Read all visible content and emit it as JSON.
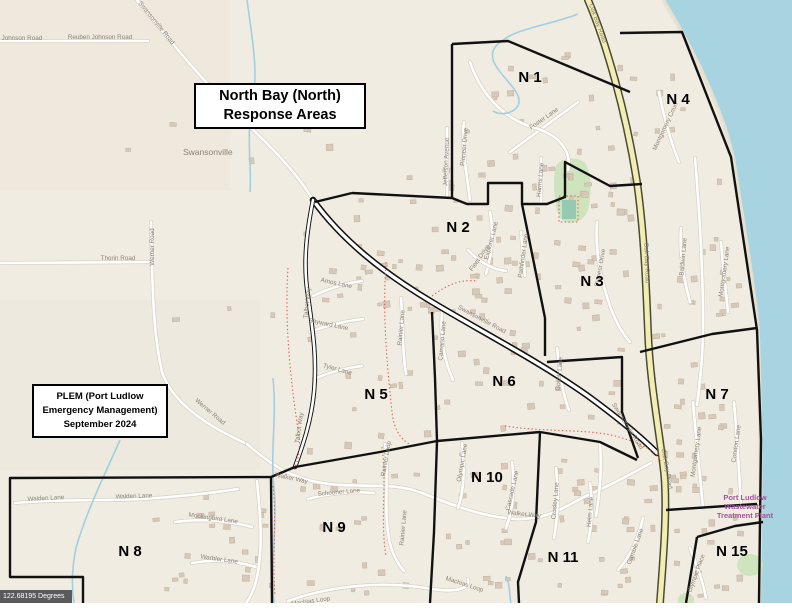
{
  "map": {
    "title_box": {
      "line1": "North Bay (North)",
      "line2": "Response Areas"
    },
    "credit_box": {
      "line1": "PLEM (Port Ludlow",
      "line2": "Emergency Management)",
      "line3": "September 2024"
    },
    "badge": {
      "text": "122.68195 Degrees"
    },
    "place": {
      "text": "Swansonville"
    },
    "poi": {
      "line1": "Port Ludlow",
      "line2": "Wastewater",
      "line3": "Treatment Plant",
      "color": "#a0549b"
    },
    "areas": [
      {
        "id": "N 1",
        "x": 530,
        "y": 82
      },
      {
        "id": "N 2",
        "x": 458,
        "y": 232
      },
      {
        "id": "N 3",
        "x": 592,
        "y": 286
      },
      {
        "id": "N 4",
        "x": 678,
        "y": 104
      },
      {
        "id": "N 5",
        "x": 376,
        "y": 399
      },
      {
        "id": "N 6",
        "x": 504,
        "y": 386
      },
      {
        "id": "N 7",
        "x": 717,
        "y": 399
      },
      {
        "id": "N 8",
        "x": 130,
        "y": 556
      },
      {
        "id": "N 9",
        "x": 334,
        "y": 532
      },
      {
        "id": "N 10",
        "x": 487,
        "y": 482
      },
      {
        "id": "N 11",
        "x": 563,
        "y": 562
      },
      {
        "id": "N 15",
        "x": 732,
        "y": 556
      }
    ],
    "street_labels": [
      {
        "t": "Reuben Johnson Road",
        "x": 100,
        "y": 39,
        "r": 0
      },
      {
        "t": "Reuben Johnson Road",
        "x": 10,
        "y": 40,
        "r": 0
      },
      {
        "t": "Swansonville Road",
        "x": 155,
        "y": 24,
        "r": 51
      },
      {
        "t": "Thorin Road",
        "x": 118,
        "y": 260,
        "r": 0
      },
      {
        "t": "Werner Road",
        "x": 154,
        "y": 247,
        "r": -90
      },
      {
        "t": "Werner Road",
        "x": 209,
        "y": 413,
        "r": 40
      },
      {
        "t": "Walden Lane",
        "x": 46,
        "y": 500,
        "r": -3
      },
      {
        "t": "Walden Lane",
        "x": 134,
        "y": 498,
        "r": -2
      },
      {
        "t": "Mockingbird Lane",
        "x": 213,
        "y": 520,
        "r": 8
      },
      {
        "t": "Warbler Lane",
        "x": 219,
        "y": 561,
        "r": 8
      },
      {
        "t": "Walker Way",
        "x": 291,
        "y": 480,
        "r": 12
      },
      {
        "t": "Walker Way",
        "x": 524,
        "y": 516,
        "r": 6
      },
      {
        "t": "Schooner Lane",
        "x": 339,
        "y": 494,
        "r": -5
      },
      {
        "t": "Machias Loop",
        "x": 311,
        "y": 603,
        "r": -8
      },
      {
        "t": "Machias Loop",
        "x": 464,
        "y": 586,
        "r": 18
      },
      {
        "t": "Rainier Loop",
        "x": 388,
        "y": 459,
        "r": -80
      },
      {
        "t": "Rainier Lane",
        "x": 405,
        "y": 528,
        "r": -85
      },
      {
        "t": "Rainier Lane",
        "x": 403,
        "y": 328,
        "r": -85
      },
      {
        "t": "Olympic Lane",
        "x": 464,
        "y": 463,
        "r": -80
      },
      {
        "t": "Cascade Lane",
        "x": 514,
        "y": 491,
        "r": -77
      },
      {
        "t": "Crosley Lane",
        "x": 557,
        "y": 501,
        "r": -85
      },
      {
        "t": "Helm Lane",
        "x": 592,
        "y": 512,
        "r": -85
      },
      {
        "t": "Gamble Lane",
        "x": 637,
        "y": 547,
        "r": -70
      },
      {
        "t": "Olympic Place",
        "x": 698,
        "y": 574,
        "r": -70
      },
      {
        "t": "Amos Lane",
        "x": 336,
        "y": 285,
        "r": 12
      },
      {
        "t": "Sayward Lane",
        "x": 328,
        "y": 326,
        "r": 12
      },
      {
        "t": "Tyler Lane",
        "x": 337,
        "y": 371,
        "r": 15
      },
      {
        "t": "Talbot Way",
        "x": 309,
        "y": 303,
        "r": -85
      },
      {
        "t": "Talbot Way",
        "x": 301,
        "y": 428,
        "r": -82
      },
      {
        "t": "Camano Lane",
        "x": 444,
        "y": 341,
        "r": -85
      },
      {
        "t": "Goliah Lane",
        "x": 561,
        "y": 374,
        "r": -85
      },
      {
        "t": "Swansonville Road",
        "x": 481,
        "y": 321,
        "r": 28
      },
      {
        "t": "Swansonville Road",
        "x": 626,
        "y": 427,
        "r": 58
      },
      {
        "t": "Oak Bay Road",
        "x": 596,
        "y": 24,
        "r": 70
      },
      {
        "t": "Oak Bay Road",
        "x": 645,
        "y": 263,
        "r": 88
      },
      {
        "t": "Oak Bay Road",
        "x": 665,
        "y": 469,
        "r": 80
      },
      {
        "t": "Jefferson Avenue",
        "x": 448,
        "y": 162,
        "r": -88
      },
      {
        "t": "Pioneer Drive",
        "x": 466,
        "y": 147,
        "r": -85
      },
      {
        "t": "Harms Lane",
        "x": 542,
        "y": 180,
        "r": -85
      },
      {
        "t": "Foster Lane",
        "x": 545,
        "y": 120,
        "r": -35
      },
      {
        "t": "Explorer Lane",
        "x": 493,
        "y": 241,
        "r": -75
      },
      {
        "t": "Fleet Drive",
        "x": 481,
        "y": 259,
        "r": -55
      },
      {
        "t": "Pathfinder Lane",
        "x": 525,
        "y": 256,
        "r": -82
      },
      {
        "t": "Pioneer Drive",
        "x": 602,
        "y": 268,
        "r": -80
      },
      {
        "t": "Baldwin Lane",
        "x": 685,
        "y": 257,
        "r": -85
      },
      {
        "t": "Montgomery Court",
        "x": 667,
        "y": 127,
        "r": -65
      },
      {
        "t": "Montgomery Lane",
        "x": 726,
        "y": 272,
        "r": -82
      },
      {
        "t": "Montgomery Lane",
        "x": 698,
        "y": 452,
        "r": -82
      },
      {
        "t": "Condon Lane",
        "x": 738,
        "y": 444,
        "r": -82
      }
    ],
    "colors": {
      "land": "#f1ece2",
      "water": "#a8d3e0",
      "park": "#cde4bd",
      "park_inner": "#96c9b2",
      "building": "#d7c9b9",
      "building_stroke": "#c2b2a0",
      "road_fill": "#ffffff",
      "road_casing": "#d8d1c4",
      "oak_bay_fill": "#f2edb5",
      "oak_bay_casing": "#4a4a33",
      "boundary": "#111111",
      "stream": "#9fd0e0",
      "trail": "#e0523c",
      "street_label": "#8b8274",
      "area_label": "#000000"
    }
  }
}
